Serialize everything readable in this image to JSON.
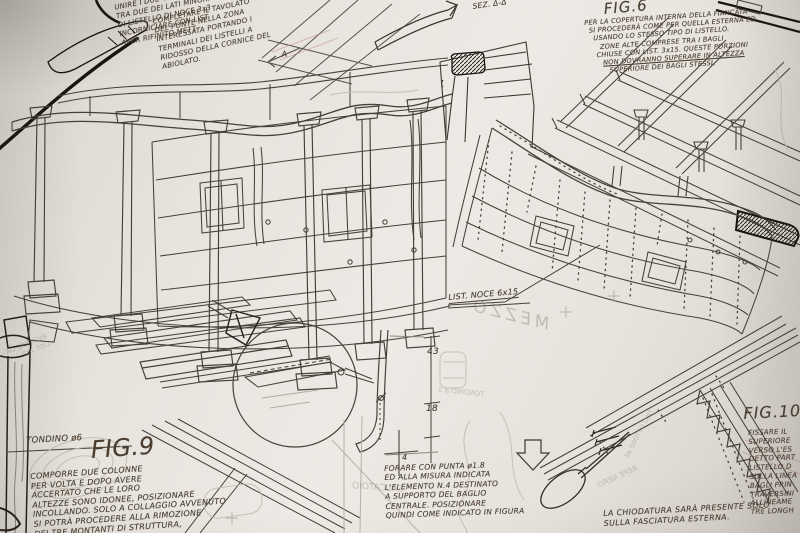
{
  "figures": {
    "fig6": {
      "title": "FIG.6",
      "lines": [
        "PER LA COPERTURA INTERNA DELLA FIANCATA",
        "SI PROCEDERÀ COME PER QUELLA ESTERNA ED",
        "USANDO LO STESSO TIPO DI LISTELLO.",
        "ZONE ALTE COMPRESE TRA I BAGLI",
        "CHIUSE CON LIST. 3x15. QUESTE PORZIONI",
        "NON DOVRANNO SUPERARE IN ALTEZZA",
        "SUPERIORE DEI BAGLI STESSI."
      ]
    },
    "fig9": {
      "title": "FIG.9",
      "lines": [
        "COMPORRE DUE COLONNE",
        "PER VOLTA E DOPO AVERE",
        "ACCERTATO CHE LE LORO",
        "ALTEZZE SONO IDONEE, POSIZIONARE",
        "INCOLLANDO. SOLO A COLLAGGIO AVVENUTO",
        "SI POTRÀ PROCEDERE ALLA RIMOZIONE",
        "DEI TRE MONTANTI DI STRUTTURA,",
        "DEI BAGLI INFERIORI"
      ]
    },
    "fig10": {
      "title": "FIG.10",
      "lines": [
        "FISSARE IL",
        "SUPERIORE",
        "VERSO L'ES",
        "DETTO PART",
        "LISTELLO D",
        "SULLA LINEA",
        "BAGLI PRIN",
        "TRAVERSINI",
        "ALLINEAME",
        "TRE LONGH"
      ]
    }
  },
  "notes": {
    "top_left_a": {
      "lines": [
        "CON CARTAVETRO",
        "UNIRE I DUE GRIGLIATI INTER",
        "TRA DUE DEI LATI MINORI",
        "DI LISTELLO DI NOCE 3x3",
        "INCORNICIARE CON LIST",
        "AVER RIFINITO METT"
      ]
    },
    "top_left_b": {
      "lines": [
        "COMPLETARE IL TAVOLATO",
        "DEL PONTE NELLA ZONA",
        "INTERESSATA PORTANDO I",
        "TERMINALI DEI LISTELLI A",
        "RIDOSSO DELLA CORNICE DEL",
        "ABIOLATO."
      ]
    },
    "drill_note": {
      "lines": [
        "FORARE CON PUNTA ø1.8",
        "ED ALLA MISURA INDICATA",
        "L'ELEMENTO N.4 DESTINATO",
        "A SUPPORTO DEL BAGLIO",
        "CENTRALE. POSIZIONARE",
        "QUINDI COME INDICATO IN FIGURA"
      ]
    },
    "nailing_note": {
      "lines": [
        "LA CHIODATURA SARÀ PRESENTE SOLO",
        "SULLA FASCIATURA ESTERNA."
      ]
    }
  },
  "labels": {
    "sez": "SEZ. Δ-Δ",
    "list_noce": "LIST. NOCE 6x15",
    "tondino": "TONDINO ø6",
    "dim_43": "43",
    "dim_18": "18",
    "elem_4": "4",
    "marker_a": "A"
  },
  "ghost_text": {
    "ricavare_1": "RICAVARE DA",
    "ricavare_2": "LIST. 2x8",
    "mezzo": "MEZZO",
    "calcatoio": "CALCATOIO",
    "refe_nero": "REFE NERO",
    "filo_ottone": "FILO OTTONE ø1",
    "tondino5": "TONDINO ø 5"
  },
  "colors": {
    "paper": "#e9e6e1",
    "ink": "#45403a",
    "ink_bold": "#17130f",
    "text_ink": "#4a3e31",
    "ghost": "#c0b9ae",
    "red_pencil": "#c4968c"
  }
}
